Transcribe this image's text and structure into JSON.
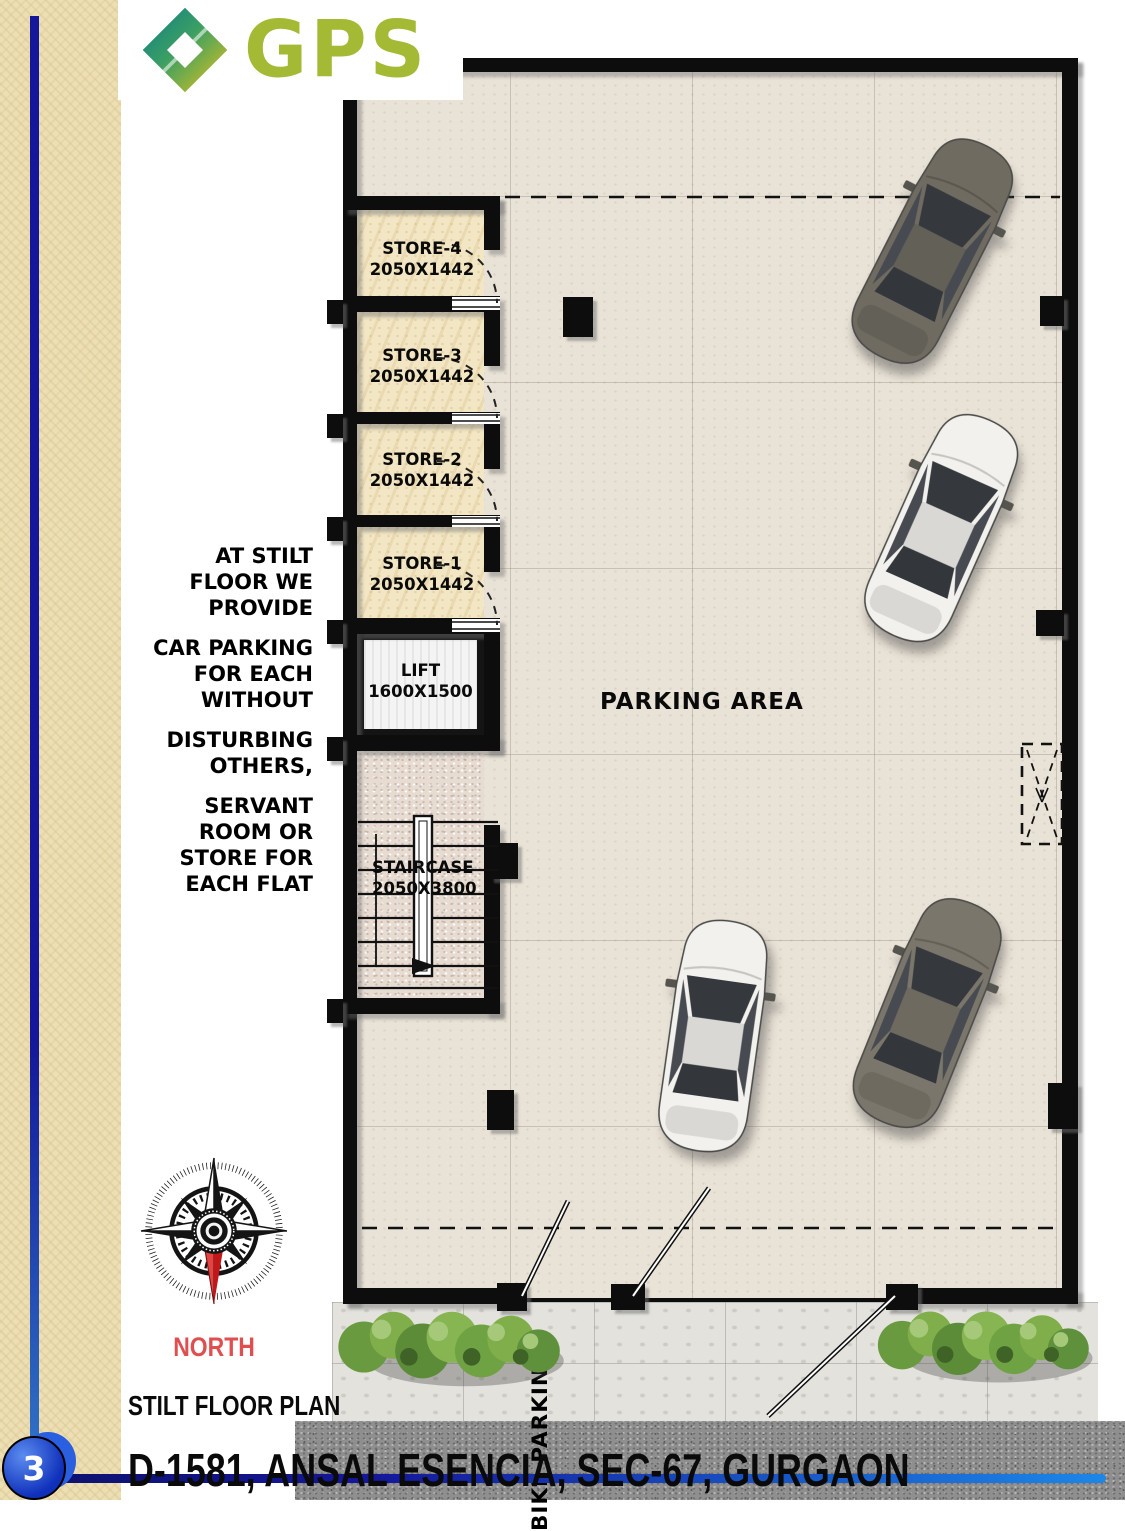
{
  "page": {
    "number": "3"
  },
  "logo": {
    "text": "GPS"
  },
  "annotation": {
    "paragraphs": [
      "AT STILT\nFLOOR WE\nPROVIDE",
      "CAR PARKING\nFOR EACH\nWITHOUT",
      "DISTURBING\nOTHERS,",
      "SERVANT\nROOM OR\nSTORE FOR\nEACH FLAT"
    ]
  },
  "plan": {
    "stores": [
      {
        "name": "STORE-4",
        "size": "2050X1442"
      },
      {
        "name": "STORE-3",
        "size": "2050X1442"
      },
      {
        "name": "STORE-2",
        "size": "2050X1442"
      },
      {
        "name": "STORE-1",
        "size": "2050X1442"
      }
    ],
    "lift": {
      "name": "LIFT",
      "size": "1600X1500"
    },
    "staircase": {
      "name": "STAIRCASE",
      "size": "2050X3800"
    },
    "parking_label": "PARKING AREA",
    "bike_label": "BIKE PARKING"
  },
  "compass": {
    "label": "NORTH"
  },
  "footer": {
    "plan_title": "STILT FLOOR PLAN",
    "address": "D-1581, ANSAL ESENCIA, SEC-67, GURGAON"
  },
  "colors": {
    "logo_green": "#a4ba35",
    "logo_teal": "#0f7f8a",
    "accent_blue": "#14179a",
    "accent_blue_light": "#1b87e8",
    "north_red": "#e04f4f",
    "wall_black": "#0d0d0d",
    "store_floor": "#f2e6c4",
    "parking_floor": "#e9e2d6"
  }
}
